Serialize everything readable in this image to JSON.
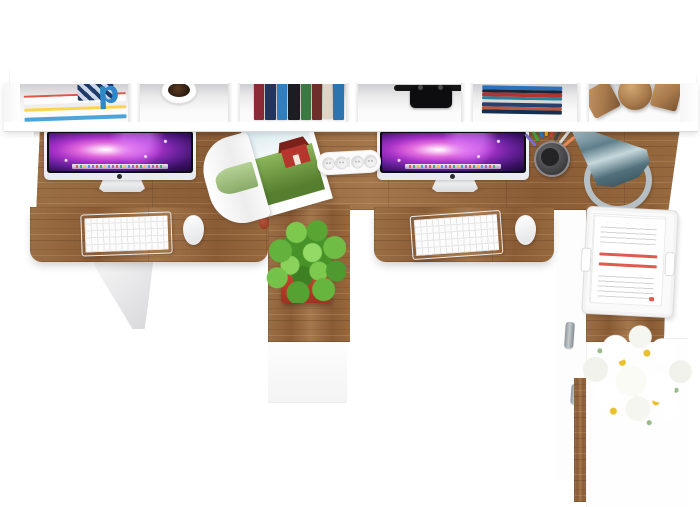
{
  "scene": {
    "type": "3d-product-render",
    "view": "top-down",
    "subject": "Two-person white office desk with oak worktop, wall shelf, two iMac workstations and storage pedestals"
  },
  "palette": {
    "wood": "#96693f",
    "wood_light": "#b08a5e",
    "wood_dark": "#6e4a2c",
    "furniture_white": "#ffffff",
    "planter_red": "#c8402e",
    "plant_green": "#5aa93c",
    "lamp_steel_blue": "#64828d",
    "screen_purple": "#a832c8",
    "flower_yellow": "#e9c12f"
  },
  "shelf": {
    "magazine_letter": "p",
    "cubby_items": [
      "magazines",
      "coffee-mug",
      "books-upright",
      "headphones",
      "books-stacked",
      "wooden-decor-cubes-and-sphere"
    ]
  },
  "desk": {
    "left_station": [
      "imac",
      "keyboard",
      "mouse"
    ],
    "right_station": [
      "imac",
      "keyboard",
      "mouse"
    ],
    "accessories": [
      "open-magazine",
      "power-strip",
      "pen-cup",
      "desk-lamp",
      "potted-plant",
      "paper-tray",
      "flower-bouquet"
    ]
  }
}
